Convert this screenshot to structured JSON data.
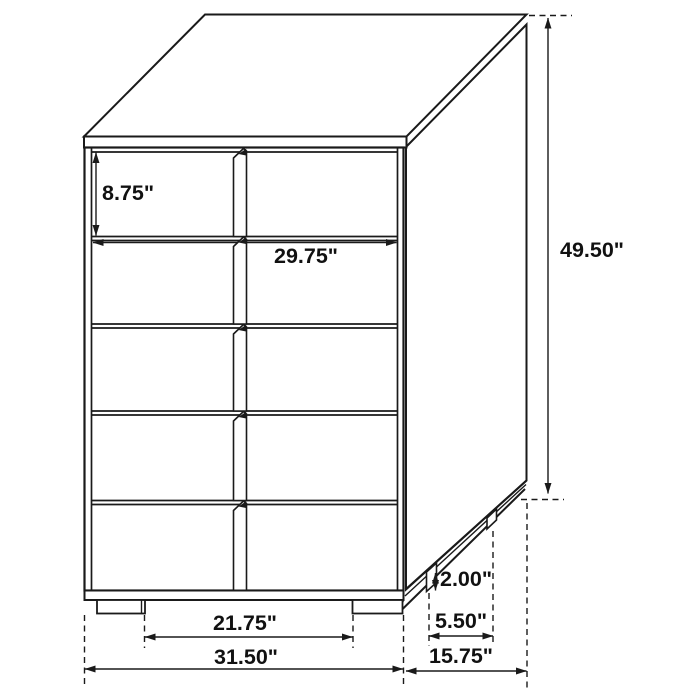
{
  "diagram": {
    "subject": "chest-of-drawers-dimension-diagram",
    "drawer_count": 5
  },
  "dimensions": {
    "drawer_height": "8.75\"",
    "drawer_width": "29.75\"",
    "overall_height": "49.50\"",
    "foot_height": "2.00\"",
    "side_foot_spacing": "5.50\"",
    "front_foot_spacing": "21.75\"",
    "overall_width": "31.50\"",
    "overall_depth": "15.75\""
  },
  "colors": {
    "line": "#1a1a1a",
    "background": "#ffffff",
    "text": "#111111"
  }
}
